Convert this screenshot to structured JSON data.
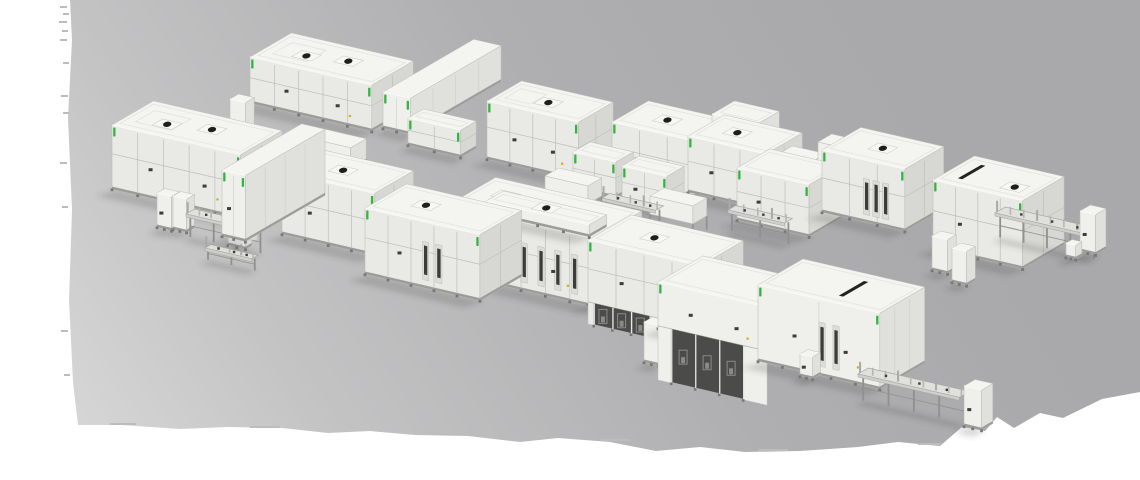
{
  "scene": {
    "viewBox": "0 0 1140 480",
    "axes": {
      "a": [
        0.974,
        0.225
      ],
      "b": [
        0.865,
        -0.502
      ]
    },
    "palette": {
      "page": "#ffffff",
      "floor_gradient": [
        "#dedede",
        "#c3c3c4",
        "#afafb1",
        "#a9a9ab"
      ],
      "roof": "#f4f4f1",
      "roof_line": "#e2e2de",
      "wall_front": "#e9e9e5",
      "wall_side": "#d7d7d3",
      "wall_plain_front": "#efefeb",
      "wall_plain_side": "#e0e0dc",
      "frame": "#bdbdb9",
      "base": "#9c9c98",
      "feet": "#77777a",
      "dark": "#3c3c3a",
      "darker": "#232321",
      "green_led": "#36b240",
      "yellow_mark": "#d4aa1e",
      "legs": "#90908d",
      "rail": "#e0e0dc",
      "rail_edge": "#a5a5a2",
      "rail_front": "#cfcfcb",
      "post": "#b5b5b2",
      "vent_plate": "#f7f7f4",
      "vent_plate_edge": "#cfcfcb",
      "vent_dark": "#1e1e1e",
      "bay_dark": "#4b4b49",
      "bay_equipment": "#8a8a88",
      "shadow": "rgba(70,70,72,0.20)",
      "edge_tick": "#bcbcbc"
    },
    "floor": {
      "points": [
        [
          70,
          0
        ],
        [
          1140,
          0
        ],
        [
          1140,
          392
        ],
        [
          1102,
          399
        ],
        [
          1063,
          418
        ],
        [
          1040,
          413
        ],
        [
          1014,
          428
        ],
        [
          997,
          417
        ],
        [
          985,
          431
        ],
        [
          962,
          427
        ],
        [
          940,
          446
        ],
        [
          898,
          442
        ],
        [
          858,
          447
        ],
        [
          800,
          451
        ],
        [
          745,
          452
        ],
        [
          700,
          447
        ],
        [
          656,
          451
        ],
        [
          610,
          442
        ],
        [
          558,
          438
        ],
        [
          520,
          442
        ],
        [
          468,
          436
        ],
        [
          415,
          435
        ],
        [
          370,
          431
        ],
        [
          328,
          433
        ],
        [
          282,
          428
        ],
        [
          228,
          427
        ],
        [
          180,
          429
        ],
        [
          122,
          425
        ],
        [
          78,
          425
        ],
        [
          73,
          382
        ],
        [
          69,
          300
        ],
        [
          72,
          210
        ],
        [
          68,
          118
        ],
        [
          72,
          40
        ]
      ],
      "edge_ticks": [
        {
          "x": 60,
          "y": 6,
          "w": 7,
          "h": 2
        },
        {
          "x": 63,
          "y": 13,
          "w": 6,
          "h": 2
        },
        {
          "x": 59,
          "y": 21,
          "w": 8,
          "h": 2
        },
        {
          "x": 62,
          "y": 30,
          "w": 6,
          "h": 2
        },
        {
          "x": 60,
          "y": 39,
          "w": 7,
          "h": 2
        },
        {
          "x": 63,
          "y": 62,
          "w": 6,
          "h": 2
        },
        {
          "x": 61,
          "y": 95,
          "w": 7,
          "h": 2
        },
        {
          "x": 63,
          "y": 112,
          "w": 6,
          "h": 2
        },
        {
          "x": 60,
          "y": 162,
          "w": 7,
          "h": 2
        },
        {
          "x": 62,
          "y": 206,
          "w": 6,
          "h": 2
        },
        {
          "x": 61,
          "y": 330,
          "w": 7,
          "h": 2
        },
        {
          "x": 64,
          "y": 374,
          "w": 6,
          "h": 2
        },
        {
          "x": 110,
          "y": 423,
          "w": 26,
          "h": 2
        },
        {
          "x": 250,
          "y": 426,
          "w": 30,
          "h": 2
        },
        {
          "x": 430,
          "y": 433,
          "w": 34,
          "h": 2
        },
        {
          "x": 600,
          "y": 439,
          "w": 30,
          "h": 2
        },
        {
          "x": 758,
          "y": 449,
          "w": 30,
          "h": 2
        },
        {
          "x": 918,
          "y": 443,
          "w": 24,
          "h": 2
        }
      ]
    },
    "machines": [
      {
        "id": "machine-rear-1",
        "t": "box",
        "x": 250,
        "y": 57,
        "a": 125,
        "b": 48,
        "h": 46,
        "f": {
          "p": 1,
          "g": 1,
          "v": [
            [
              0.32,
              0.42
            ],
            [
              0.62,
              0.55
            ]
          ],
          "m": 2,
          "rr": 1
        }
      },
      {
        "id": "cabinet-rear-1-end",
        "t": "box",
        "x": 230,
        "y": 99,
        "a": 16,
        "b": 10,
        "h": 34,
        "f": {}
      },
      {
        "id": "buffer-tunnel-rear",
        "t": "box",
        "x": 383,
        "y": 92,
        "a": 28,
        "b": 105,
        "h": 36,
        "f": {
          "s": 1,
          "g": 1
        }
      },
      {
        "id": "module-rear-small-1",
        "t": "box",
        "x": 408,
        "y": 118,
        "a": 54,
        "b": 18,
        "h": 27,
        "f": {
          "p": 1,
          "g": 1
        }
      },
      {
        "id": "machine-rear-2",
        "t": "box",
        "x": 487,
        "y": 101,
        "a": 94,
        "b": 40,
        "h": 58,
        "f": {
          "p": 1,
          "g": 1,
          "v": [
            [
              0.5,
              0.45
            ]
          ],
          "m": 2,
          "rr": 1
        }
      },
      {
        "id": "machine-rear-3",
        "t": "box",
        "x": 612,
        "y": 122,
        "a": 85,
        "b": 42,
        "h": 56,
        "f": {
          "p": 1,
          "g": 1,
          "v": [
            [
              0.45,
              0.5
            ]
          ],
          "m": 1
        }
      },
      {
        "id": "machine-rear-4-rooftop",
        "t": "box",
        "x": 712,
        "y": 114,
        "a": 46,
        "b": 26,
        "h": 20,
        "f": {}
      },
      {
        "id": "machine-rear-4",
        "t": "box",
        "x": 688,
        "y": 136,
        "a": 80,
        "b": 42,
        "h": 56,
        "f": {
          "p": 1,
          "g": 1,
          "v": [
            [
              0.4,
              0.5
            ]
          ],
          "m": 1
        }
      },
      {
        "id": "walkway-rear",
        "t": "bridge",
        "x": 782,
        "y": 152,
        "a": 34,
        "b": 12,
        "h": 12,
        "f": {
          "ld": 20
        }
      },
      {
        "id": "platform-rear",
        "t": "bridge",
        "x": 818,
        "y": 142,
        "a": 22,
        "b": 16,
        "h": 26,
        "f": {
          "ld": 12
        }
      },
      {
        "id": "machine-rear-5",
        "t": "box",
        "x": 737,
        "y": 168,
        "a": 74,
        "b": 38,
        "h": 52,
        "f": {
          "p": 1,
          "g": 1,
          "m": 1
        }
      },
      {
        "id": "machine-rear-6",
        "t": "box",
        "x": 822,
        "y": 150,
        "a": 85,
        "b": 45,
        "h": 62,
        "f": {
          "p": 1,
          "g": 1,
          "v": [
            [
              0.5,
              0.5
            ]
          ],
          "d": 3
        }
      },
      {
        "id": "layup-machine-rear",
        "t": "box",
        "x": 933,
        "y": 180,
        "a": 92,
        "b": 48,
        "h": 68,
        "f": {
          "p": 1,
          "g": 1,
          "slot": 0.2,
          "v": [
            [
              0.75,
              0.35
            ]
          ],
          "m": 1
        }
      },
      {
        "id": "exit-conveyor-rear",
        "t": "conv",
        "x": 995,
        "y": 213,
        "a": 96,
        "b": 12,
        "h": 26,
        "f": {}
      },
      {
        "id": "end-cabinet-rear",
        "t": "box",
        "x": 1080,
        "y": 211,
        "a": 16,
        "b": 12,
        "h": 40,
        "f": {
          "m": 1
        }
      },
      {
        "id": "small-unit-rear",
        "t": "box",
        "x": 1066,
        "y": 243,
        "a": 10,
        "b": 7,
        "h": 14,
        "f": {}
      },
      {
        "id": "module-rear-small-2",
        "t": "box",
        "x": 573,
        "y": 152,
        "a": 44,
        "b": 20,
        "h": 36,
        "f": {
          "p": 1,
          "g": 1
        }
      },
      {
        "id": "module-rear-small-3",
        "t": "box",
        "x": 622,
        "y": 166,
        "a": 46,
        "b": 20,
        "h": 36,
        "f": {
          "p": 1,
          "g": 1,
          "m": 1
        }
      },
      {
        "id": "link-bridge-1",
        "t": "bridge",
        "x": 300,
        "y": 136,
        "a": 52,
        "b": 18,
        "h": 20,
        "f": {
          "ld": 14
        }
      },
      {
        "id": "link-bridge-2",
        "t": "bridge",
        "x": 545,
        "y": 176,
        "a": 44,
        "b": 16,
        "h": 18,
        "f": {
          "ld": 14
        }
      },
      {
        "id": "link-bridge-3",
        "t": "bridge",
        "x": 650,
        "y": 196,
        "a": 44,
        "b": 16,
        "h": 18,
        "f": {
          "ld": 14
        }
      },
      {
        "id": "ground-conveyor-2",
        "t": "conv",
        "x": 602,
        "y": 198,
        "a": 55,
        "b": 9,
        "h": 22,
        "f": {}
      },
      {
        "id": "ground-conveyor-3",
        "t": "conv",
        "x": 728,
        "y": 210,
        "a": 58,
        "b": 9,
        "h": 22,
        "f": {}
      },
      {
        "id": "machine-front-1",
        "t": "box",
        "x": 112,
        "y": 125,
        "a": 132,
        "b": 48,
        "h": 64,
        "f": {
          "p": 1,
          "g": 1,
          "v": [
            [
              0.3,
              0.4
            ],
            [
              0.6,
              0.55
            ]
          ],
          "m": 2,
          "rr": 1
        }
      },
      {
        "id": "loader-cabinet-1",
        "t": "box",
        "x": 157,
        "y": 193,
        "a": 15,
        "b": 9,
        "h": 34,
        "f": {
          "m": 1
        }
      },
      {
        "id": "loader-cabinet-2",
        "t": "box",
        "x": 173,
        "y": 196,
        "a": 14,
        "b": 9,
        "h": 33,
        "f": {}
      },
      {
        "id": "loader-conveyor",
        "t": "conv",
        "x": 186,
        "y": 214,
        "a": 72,
        "b": 10,
        "h": 24,
        "f": {}
      },
      {
        "id": "loader-sled",
        "t": "box",
        "x": 228,
        "y": 236,
        "a": 18,
        "b": 7,
        "h": 9,
        "f": {}
      },
      {
        "id": "loader-rail",
        "t": "conv",
        "x": 205,
        "y": 248,
        "a": 48,
        "b": 7,
        "h": 12,
        "f": {}
      },
      {
        "id": "loader-robot-arm",
        "t": "arm",
        "x": 252,
        "y": 238,
        "a": 0,
        "b": 0,
        "h": 0,
        "f": {}
      },
      {
        "id": "machine-front-2",
        "t": "box",
        "x": 282,
        "y": 172,
        "a": 95,
        "b": 45,
        "h": 62,
        "f": {
          "p": 1,
          "g": 1,
          "v": [
            [
              0.45,
              0.5
            ]
          ],
          "m": 1
        }
      },
      {
        "id": "buffer-tunnel-front",
        "t": "box",
        "x": 222,
        "y": 170,
        "a": 24,
        "b": 92,
        "h": 66,
        "f": {
          "s": 1,
          "g": 1,
          "m": 1
        }
      },
      {
        "id": "machine-front-4",
        "t": "box",
        "x": 448,
        "y": 205,
        "a": 150,
        "b": 55,
        "h": 68,
        "f": {
          "p": 1,
          "g": 1,
          "v": [
            [
              0.2,
              0.6
            ]
          ],
          "d": 4,
          "m": 2
        }
      },
      {
        "id": "machine-front-4-roof",
        "t": "box",
        "x": 486,
        "y": 201,
        "a": 106,
        "b": 20,
        "h": 12,
        "f": {
          "v": [
            [
              0.5,
              0.5
            ]
          ]
        }
      },
      {
        "id": "ground-conveyor-1",
        "t": "conv",
        "x": 442,
        "y": 212,
        "a": 42,
        "b": 9,
        "h": 24,
        "f": {}
      },
      {
        "id": "machine-front-3",
        "t": "box",
        "x": 365,
        "y": 208,
        "a": 118,
        "b": 48,
        "h": 66,
        "f": {
          "p": 1,
          "g": 1,
          "v": [
            [
              0.35,
              0.5
            ]
          ],
          "d": 2,
          "m": 1
        }
      },
      {
        "id": "machine-front-5",
        "t": "box",
        "x": 588,
        "y": 240,
        "a": 115,
        "b": 50,
        "h": 64,
        "f": {
          "p": 1,
          "g": 1,
          "v": [
            [
              0.4,
              0.5
            ]
          ],
          "ub": {
            "n": 3,
            "drop": 20,
            "start": 0.05,
            "end": 0.55
          },
          "m": 1
        }
      },
      {
        "id": "stringer-cabinet",
        "t": "box",
        "x": 644,
        "y": 322,
        "a": 15,
        "b": 10,
        "h": 40,
        "f": {}
      },
      {
        "id": "stringer-machine",
        "t": "box",
        "x": 658,
        "y": 282,
        "a": 112,
        "b": 52,
        "h": 46,
        "f": {
          "g": 1,
          "m": 2,
          "ub": {
            "n": 3,
            "drop": 52,
            "start": 0.12,
            "end": 0.78
          }
        }
      },
      {
        "id": "machine-front-6",
        "t": "box",
        "x": 758,
        "y": 285,
        "a": 125,
        "b": 52,
        "h": 76,
        "f": {
          "s": 1,
          "g": 1,
          "slot": 0.6,
          "d": 2,
          "m": 2
        }
      },
      {
        "id": "control-pedestal",
        "t": "box",
        "x": 800,
        "y": 354,
        "a": 13,
        "b": 9,
        "h": 22,
        "f": {
          "m": 1
        }
      },
      {
        "id": "sub-cabinet-1",
        "t": "box",
        "x": 932,
        "y": 236,
        "a": 16,
        "b": 10,
        "h": 34,
        "f": {}
      },
      {
        "id": "sub-cabinet-2",
        "t": "box",
        "x": 952,
        "y": 248,
        "a": 15,
        "b": 10,
        "h": 34,
        "f": {}
      },
      {
        "id": "exit-conveyor-front",
        "t": "conv",
        "x": 858,
        "y": 374,
        "a": 104,
        "b": 12,
        "h": 28,
        "f": {}
      },
      {
        "id": "end-cabinet-front",
        "t": "box",
        "x": 964,
        "y": 386,
        "a": 18,
        "b": 13,
        "h": 40,
        "f": {
          "m": 1
        }
      }
    ]
  }
}
